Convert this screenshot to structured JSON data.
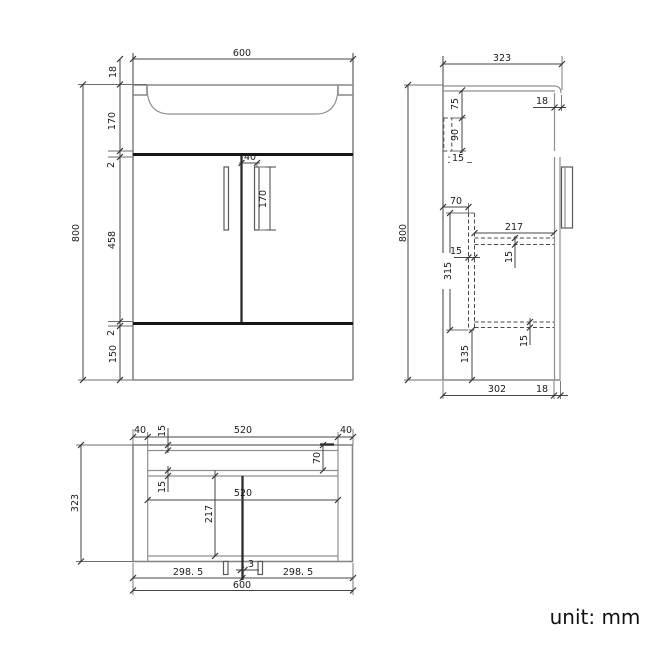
{
  "note": {
    "unit_label": "unit: mm"
  },
  "front_view": {
    "width": "600",
    "overall_height": "800",
    "top_rim": "18",
    "basin_height": "170",
    "gap_top": "2",
    "door_height": "458",
    "gap_bottom": "2",
    "plinth_height": "150",
    "handle_offset": "40",
    "handle_length": "170"
  },
  "side_view": {
    "depth": "323",
    "overall_height": "800",
    "counter_front_thickness": "18",
    "bracket_top_offset": "75",
    "bracket_height": "90",
    "bracket_below": "15",
    "divider_inset": "70",
    "divider_height": "315",
    "divider_thickness": "15",
    "shelf_depth": "217",
    "shelf_thickness": "15",
    "bottom_panel_thickness": "15",
    "plinth_height": "135",
    "body_depth": "302",
    "door_thickness": "18"
  },
  "plan_view": {
    "side_panel_left": "40",
    "inner_width_top": "520",
    "side_panel_right": "40",
    "back_panel_thickness": "15",
    "front_rail_inset": "70",
    "rail_thickness": "15",
    "inner_width": "520",
    "inner_depth": "217",
    "door_gap": "3",
    "door_width_left": "298. 5",
    "door_width_right": "298. 5",
    "width": "600",
    "depth": "323"
  }
}
